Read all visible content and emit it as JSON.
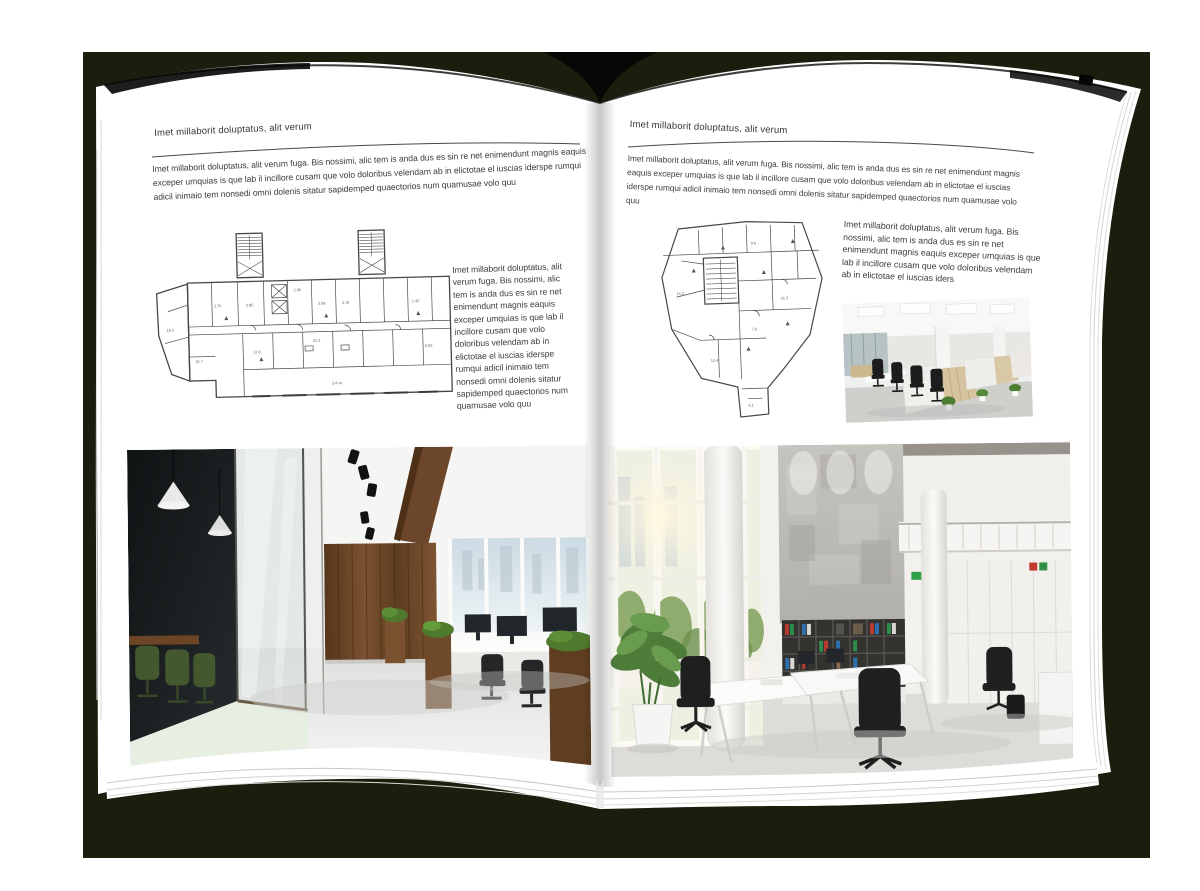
{
  "colors": {
    "backdrop": "#1c1e0d",
    "page": "#ffffff",
    "text": "#3d3d3d",
    "rule": "#4a4a4a",
    "wood": "#6e4a2b",
    "plant_green": "#4e7d3a",
    "binder_red": "#b93a30",
    "binder_green": "#2e8c4a",
    "binder_blue": "#2e6fae"
  },
  "book": {
    "left_page": {
      "header": "Imet millaborit doluptatus, alit verum",
      "intro": "Imet millaborit doluptatus, alit verum fuga. Bis nossimi, alic tem is anda dus es sin re net enimendunt magnis eaquis exceper umquias is que lab il incillore cusam que volo doloribus velendam ab in elictotae el iuscias iderspe rumqui adicil inimaio tem nonsedi omni dolenis sitatur sapidemped quaectorios num quamusae volo quu",
      "caption": "Imet millaborit doluptatus, alit verum fuga. Bis nossimi, alic tem is anda dus es sin re net enimendunt magnis eaquis exceper umquias is que lab il incillore cusam que volo doloribus velendam ab in elictotae el iuscias iderspe rumqui adicil inimaio tem nonsedi omni dolenis sitatur sapidemped quaectorios num quamusae volo quu",
      "floor_plan_labels": [
        "2.75",
        "2.85",
        "2.95",
        "3.09",
        "3.76",
        "1.43",
        "5.82",
        "24.7",
        "18.3",
        "12.8",
        "41.2",
        "2-й эт."
      ]
    },
    "right_page": {
      "header": "Imet millaborit doluptatus, alit verum",
      "intro": "Imet millaborit doluptatus, alit verum fuga. Bis nossimi, alic tem is anda dus es sin re net enimendunt magnis eaquis exceper umquias is que lab il incillore cusam que volo doloribus velendam ab in elictotae el iuscias iderspe rumqui adicil inimaio tem nonsedi omni dolenis sitatur sapidemped quaectorios num quamusae volo quu",
      "caption": "Imet millaborit doluptatus, alit verum fuga. Bis nossimi, alic tem is anda dus es sin re net enimendunt magnis eaquis exceper umquias is que lab il incillore cusam que volo doloribus velendam ab in elictotae el iuscias iders",
      "floor_plan_labels": [
        "14.2",
        "9.6",
        "21.3",
        "7.8",
        "12.4",
        "5.1"
      ]
    }
  }
}
